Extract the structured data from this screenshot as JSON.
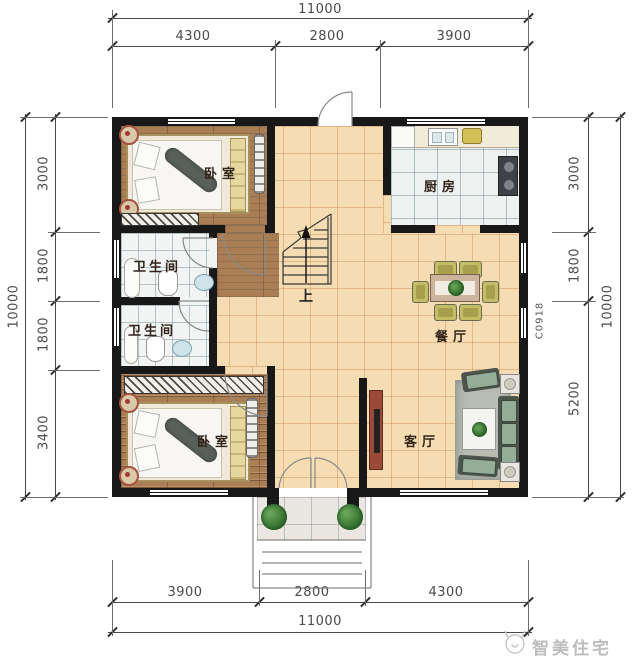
{
  "dims": {
    "top_total": "11000",
    "top_segments": [
      "4300",
      "2800",
      "3900"
    ],
    "bottom_segments": [
      "3900",
      "2800",
      "4300"
    ],
    "bottom_total": "11000",
    "left_total": "10000",
    "left_segments": [
      "3000",
      "1800",
      "1800",
      "3400"
    ],
    "right_total": "10000",
    "right_segments": [
      "3000",
      "1800",
      "5200"
    ]
  },
  "rooms": {
    "bedroom_top": "卧室",
    "kitchen": "厨房",
    "bathroom_upper": "卫生间",
    "bathroom_lower": "卫生间",
    "dining": "餐厅",
    "living": "客厅",
    "bedroom_bottom": "卧室"
  },
  "stairs": {
    "up": "上"
  },
  "labels": {
    "window_code": "C0918"
  },
  "watermark": {
    "brand": "智美住宅"
  },
  "colors": {
    "wall": "#181818",
    "floor_wood": "#aa7e55",
    "floor_beige": "#f6dcb2",
    "floor_tile": "#f1f4f3",
    "plant_green": "#3f7d3a",
    "dim_text": "#4a4a4a"
  }
}
